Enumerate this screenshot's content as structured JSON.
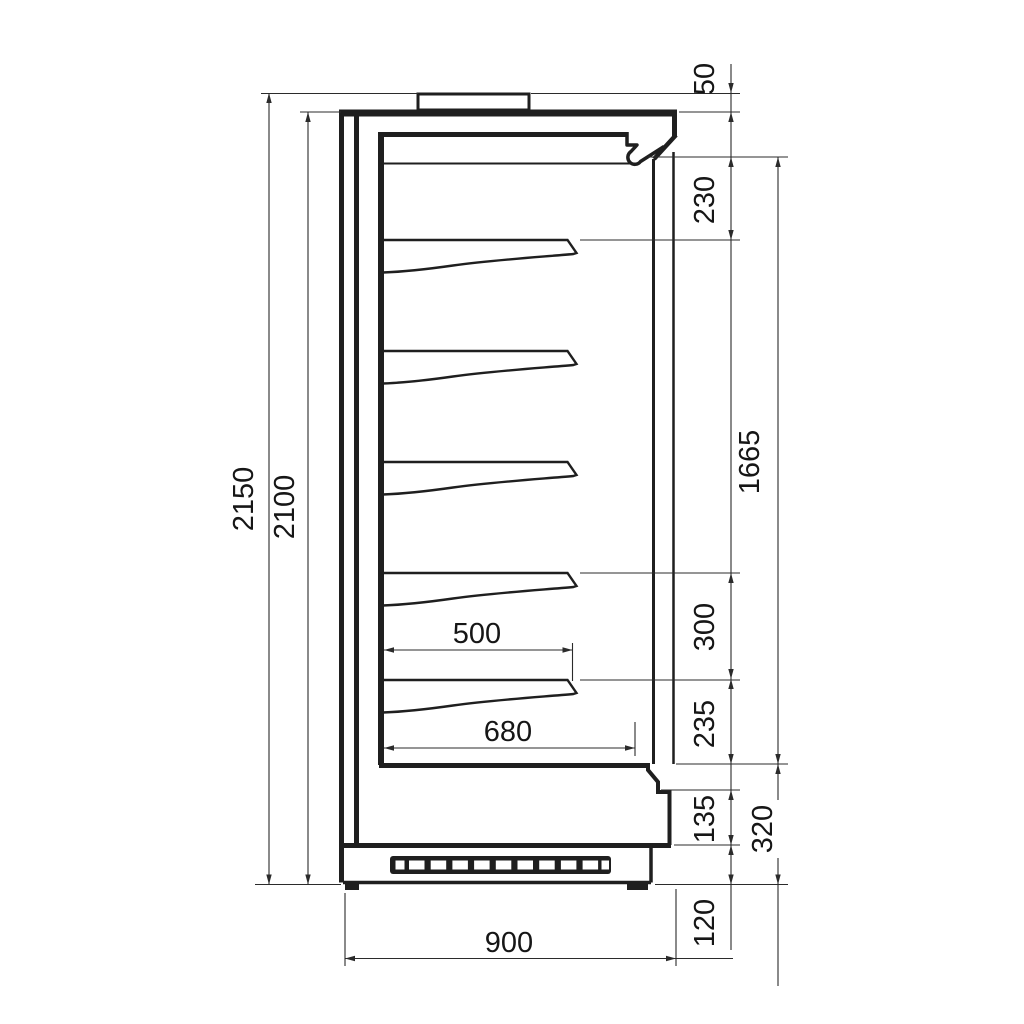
{
  "drawing": {
    "kind": "refrigerated-display-cabinet-side-section",
    "dimensions": {
      "overall_height": "2150",
      "body_height": "2100",
      "top_box_height": "50",
      "canopy_to_first_shelf": "230",
      "display_opening_height": "1665",
      "shelf_pitch": "300",
      "last_shelf_to_well": "235",
      "lower_front_height": "135",
      "base_section_height": "320",
      "plinth_height": "120",
      "shelf_depth": "500",
      "well_depth": "680",
      "overall_depth": "900"
    },
    "line_color": "#1f1f1f",
    "background_color": "#ffffff"
  }
}
